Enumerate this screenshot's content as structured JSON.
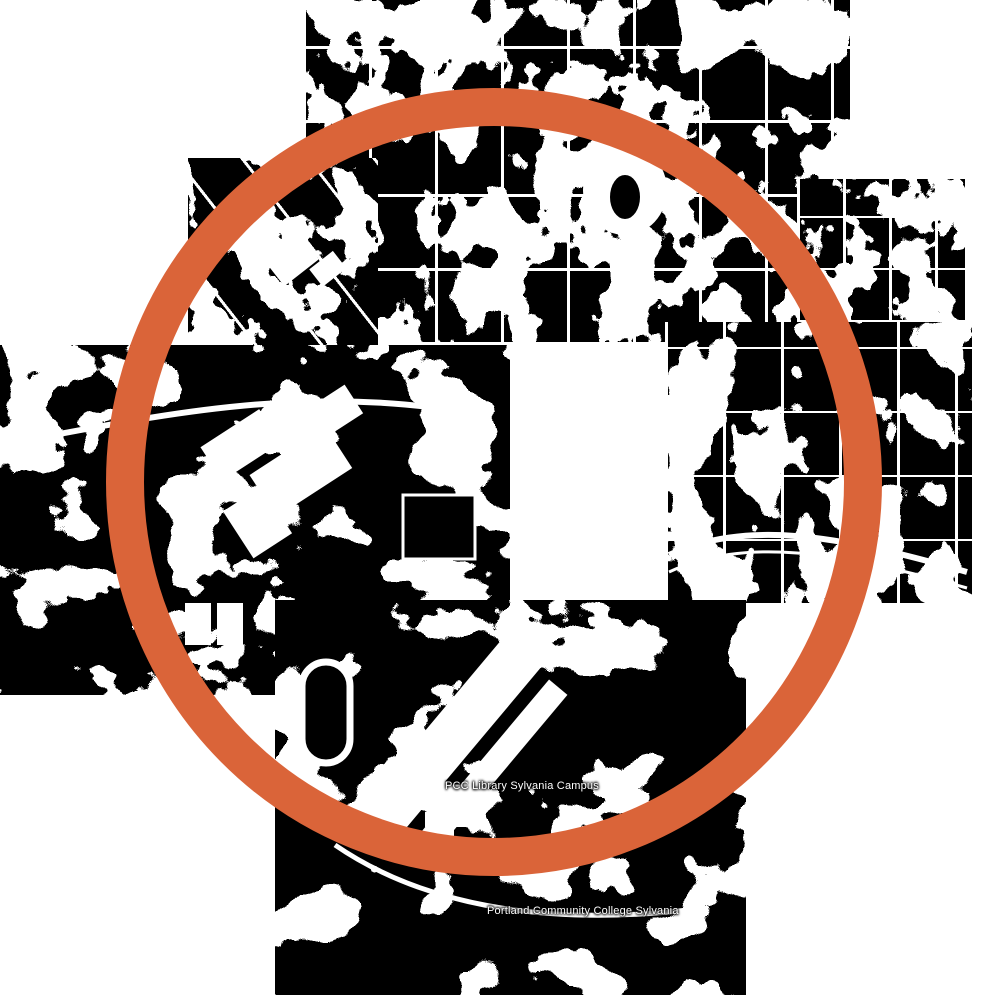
{
  "map": {
    "background_color": "#ffffff",
    "tile_color": "#000000",
    "feature_color": "#ffffff",
    "ring": {
      "color": "#DA6439"
    },
    "labels": [
      {
        "text": "PCC Library Sylvania Campus"
      },
      {
        "text": "Portland Community College Sylvania"
      }
    ]
  }
}
